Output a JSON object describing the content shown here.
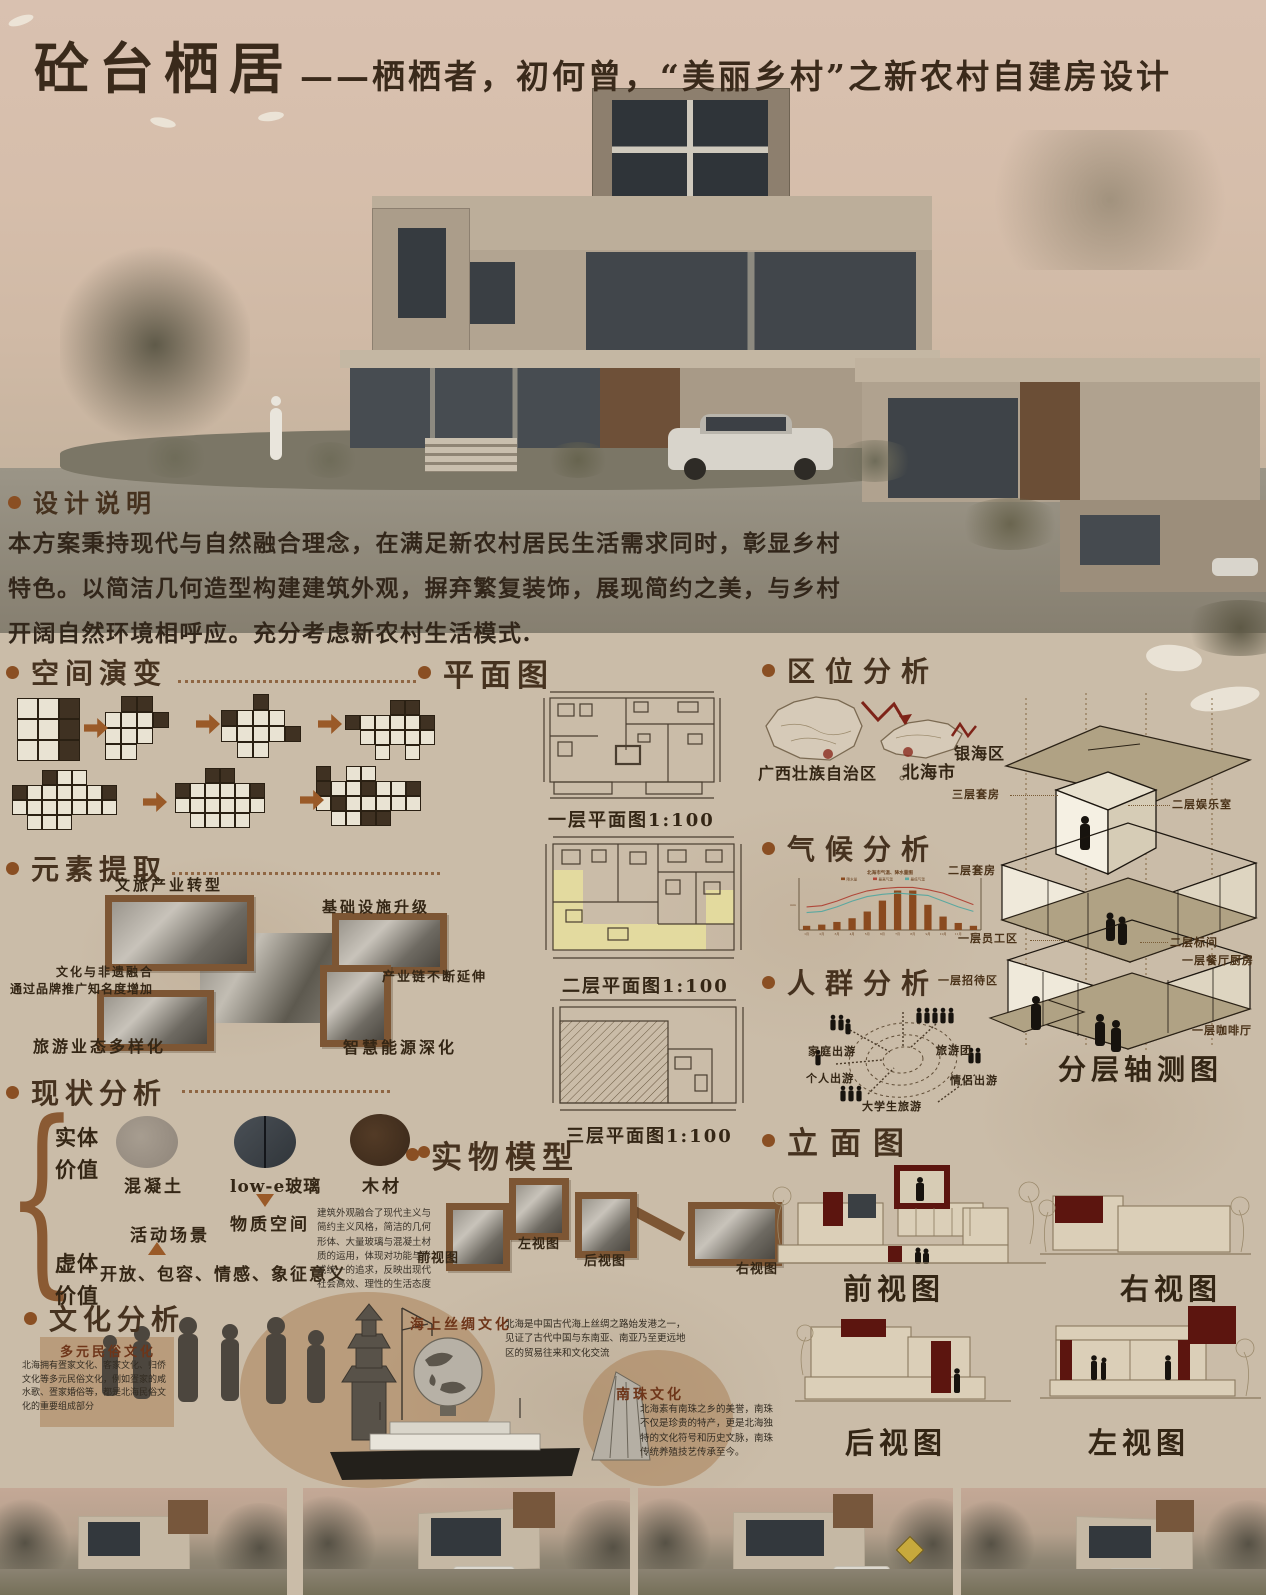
{
  "title": {
    "main": "砼台栖居",
    "sub": "——栖栖者，初何曾，“美丽乡村”之新农村自建房设计"
  },
  "design_note": {
    "heading": "设计说明",
    "body": "本方案秉持现代与自然融合理念，在满足新农村居民生活需求同时，彰显乡村特色。以简洁几何造型构建建筑外观，摒弃繁复装饰，展现简约之美，与乡村开阔自然环境相呼应。充分考虑新农村生活模式."
  },
  "space_evolution": {
    "heading": "空间演变"
  },
  "plans": {
    "heading": "平面图",
    "floor1_label": "一层平面图1:100",
    "floor2_label": "二层平面图1:100",
    "floor3_label": "三层平面图1:100"
  },
  "location": {
    "heading": "区位分析",
    "region_province": "广西壮族自治区",
    "region_city": "北海市",
    "region_district": "银海区"
  },
  "climate": {
    "heading": "气候分析"
  },
  "chart_data": {
    "type": "bar",
    "title": "北海市气温、降水量图",
    "categories": [
      "1月",
      "2月",
      "3月",
      "4月",
      "5月",
      "6月",
      "7月",
      "8月",
      "9月",
      "10月",
      "11月",
      "12月"
    ],
    "series": [
      {
        "name": "降水量",
        "type": "bar",
        "values": [
          25,
          32,
          48,
          70,
          110,
          175,
          235,
          235,
          150,
          80,
          42,
          25
        ]
      },
      {
        "name": "最高气温",
        "type": "line",
        "values": [
          15,
          16,
          20,
          25,
          29,
          31,
          32,
          32,
          30,
          27,
          22,
          17
        ]
      },
      {
        "name": "最低气温",
        "type": "line",
        "values": [
          10,
          11,
          15,
          20,
          24,
          26,
          27,
          26,
          25,
          20,
          15,
          11
        ]
      }
    ],
    "ylim_precip": [
      0,
      250
    ],
    "ylim_temp": [
      0,
      35
    ],
    "legend_position": "top",
    "grid": false
  },
  "people": {
    "heading": "人群分析",
    "groups": [
      "家庭出游",
      "个人出游",
      "大学生旅游",
      "旅游团",
      "情侣出游"
    ]
  },
  "axon": {
    "caption": "分层轴测图",
    "left_labels": [
      "三层套房",
      "二层套房",
      "一层员工区",
      "一层招待区"
    ],
    "right_labels": [
      "二层娱乐室",
      "二层标间",
      "一层餐厅厨房",
      "一层咖啡厅"
    ]
  },
  "elements": {
    "heading": "元素提取",
    "labels": [
      "文旅产业转型",
      "基础设施升级",
      "文化与非遗融合",
      "通过品牌推广知名度增加",
      "产业链不断延伸",
      "旅游业态多样化",
      "智慧能源深化"
    ]
  },
  "status": {
    "heading": "现状分析",
    "solid_label": "实体\n价值",
    "virtual_label": "虚体\n价值",
    "materials": [
      "混凝土",
      "low-e玻璃",
      "木材"
    ],
    "material_space": "物质空间",
    "activity": "活动场景",
    "virtual_values": "开放、包容、情感、象征意义",
    "note": "建筑外观融合了现代主义与简约主义风格，简洁的几何形体、大量玻璃与混凝土材质的运用，体现对功能与形式统一的追求，反映出现代社会高效、理性的生活态度"
  },
  "model": {
    "heading": "实物模型",
    "views": [
      "前视图",
      "左视图",
      "后视图",
      "右视图"
    ]
  },
  "culture": {
    "heading": "文化分析",
    "folk_title": "多元民俗文化",
    "folk_text": "北海拥有疍家文化、客家文化、归侨文化等多元民俗文化，例如疍家的咸水歌、疍家婚俗等，都是北海民俗文化的重要组成部分",
    "silk_title": "海上丝绸文化",
    "silk_text": "北海是中国古代海上丝绸之路始发港之一，见证了古代中国与东南亚、南亚乃至更远地区的贸易往来和文化交流",
    "pearl_title": "南珠文化",
    "pearl_text": "北海素有南珠之乡的美誉，南珠不仅是珍贵的特产，更是北海独特的文化符号和历史文脉，南珠传统养殖技艺传承至今。"
  },
  "elevations": {
    "heading": "立面图",
    "views": [
      "前视图",
      "右视图",
      "后视图",
      "左视图"
    ]
  }
}
